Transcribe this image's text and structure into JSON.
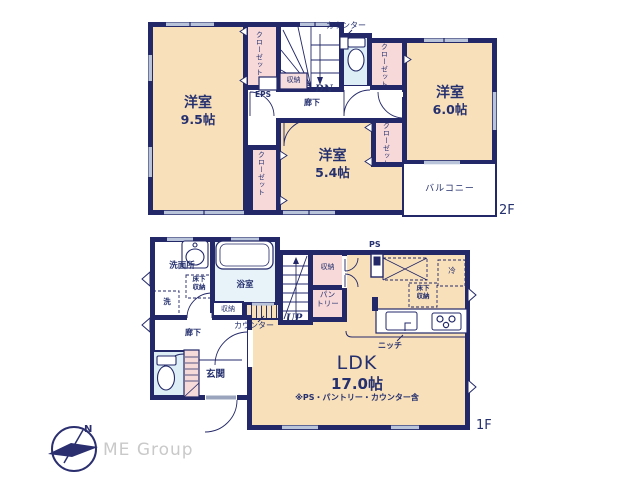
{
  "floor2": {
    "floor_label": "2F",
    "room95_name": "洋室",
    "room95_size": "9.5帖",
    "room54_name": "洋室",
    "room54_size": "5.4帖",
    "room60_name": "洋室",
    "room60_size": "6.0帖",
    "closet": "クローゼット",
    "counter": "カウンター",
    "storage": "収納",
    "eps": "EPS",
    "dn": "DN",
    "hallway": "廊下",
    "balcony": "バルコニー"
  },
  "floor1": {
    "floor_label": "1F",
    "ldk_name": "LDK",
    "ldk_size": "17.0帖",
    "ldk_note": "※PS・パントリー・カウンター含",
    "washroom": "洗面所",
    "bath": "浴室",
    "washer": "洗",
    "underfloor_line1": "床下",
    "underfloor_line2": "収納",
    "storage": "収納",
    "pantry_line1": "パン",
    "pantry_line2": "トリー",
    "counter": "カウンター",
    "up": "UP",
    "hallway": "廊下",
    "entrance": "玄関",
    "ps": "PS",
    "fridge": "冷",
    "niche": "ニッチ"
  },
  "logo": {
    "brand": "ME Group",
    "north": "N"
  },
  "colors": {
    "wall": "#232868",
    "text": "#25306e",
    "room_fill": "#f8e0bb",
    "closet_fill": "#f7d9d9",
    "water_fill": "#ddeef6",
    "window": "#b9c3d9",
    "logo_gray": "#c9c9c9"
  }
}
